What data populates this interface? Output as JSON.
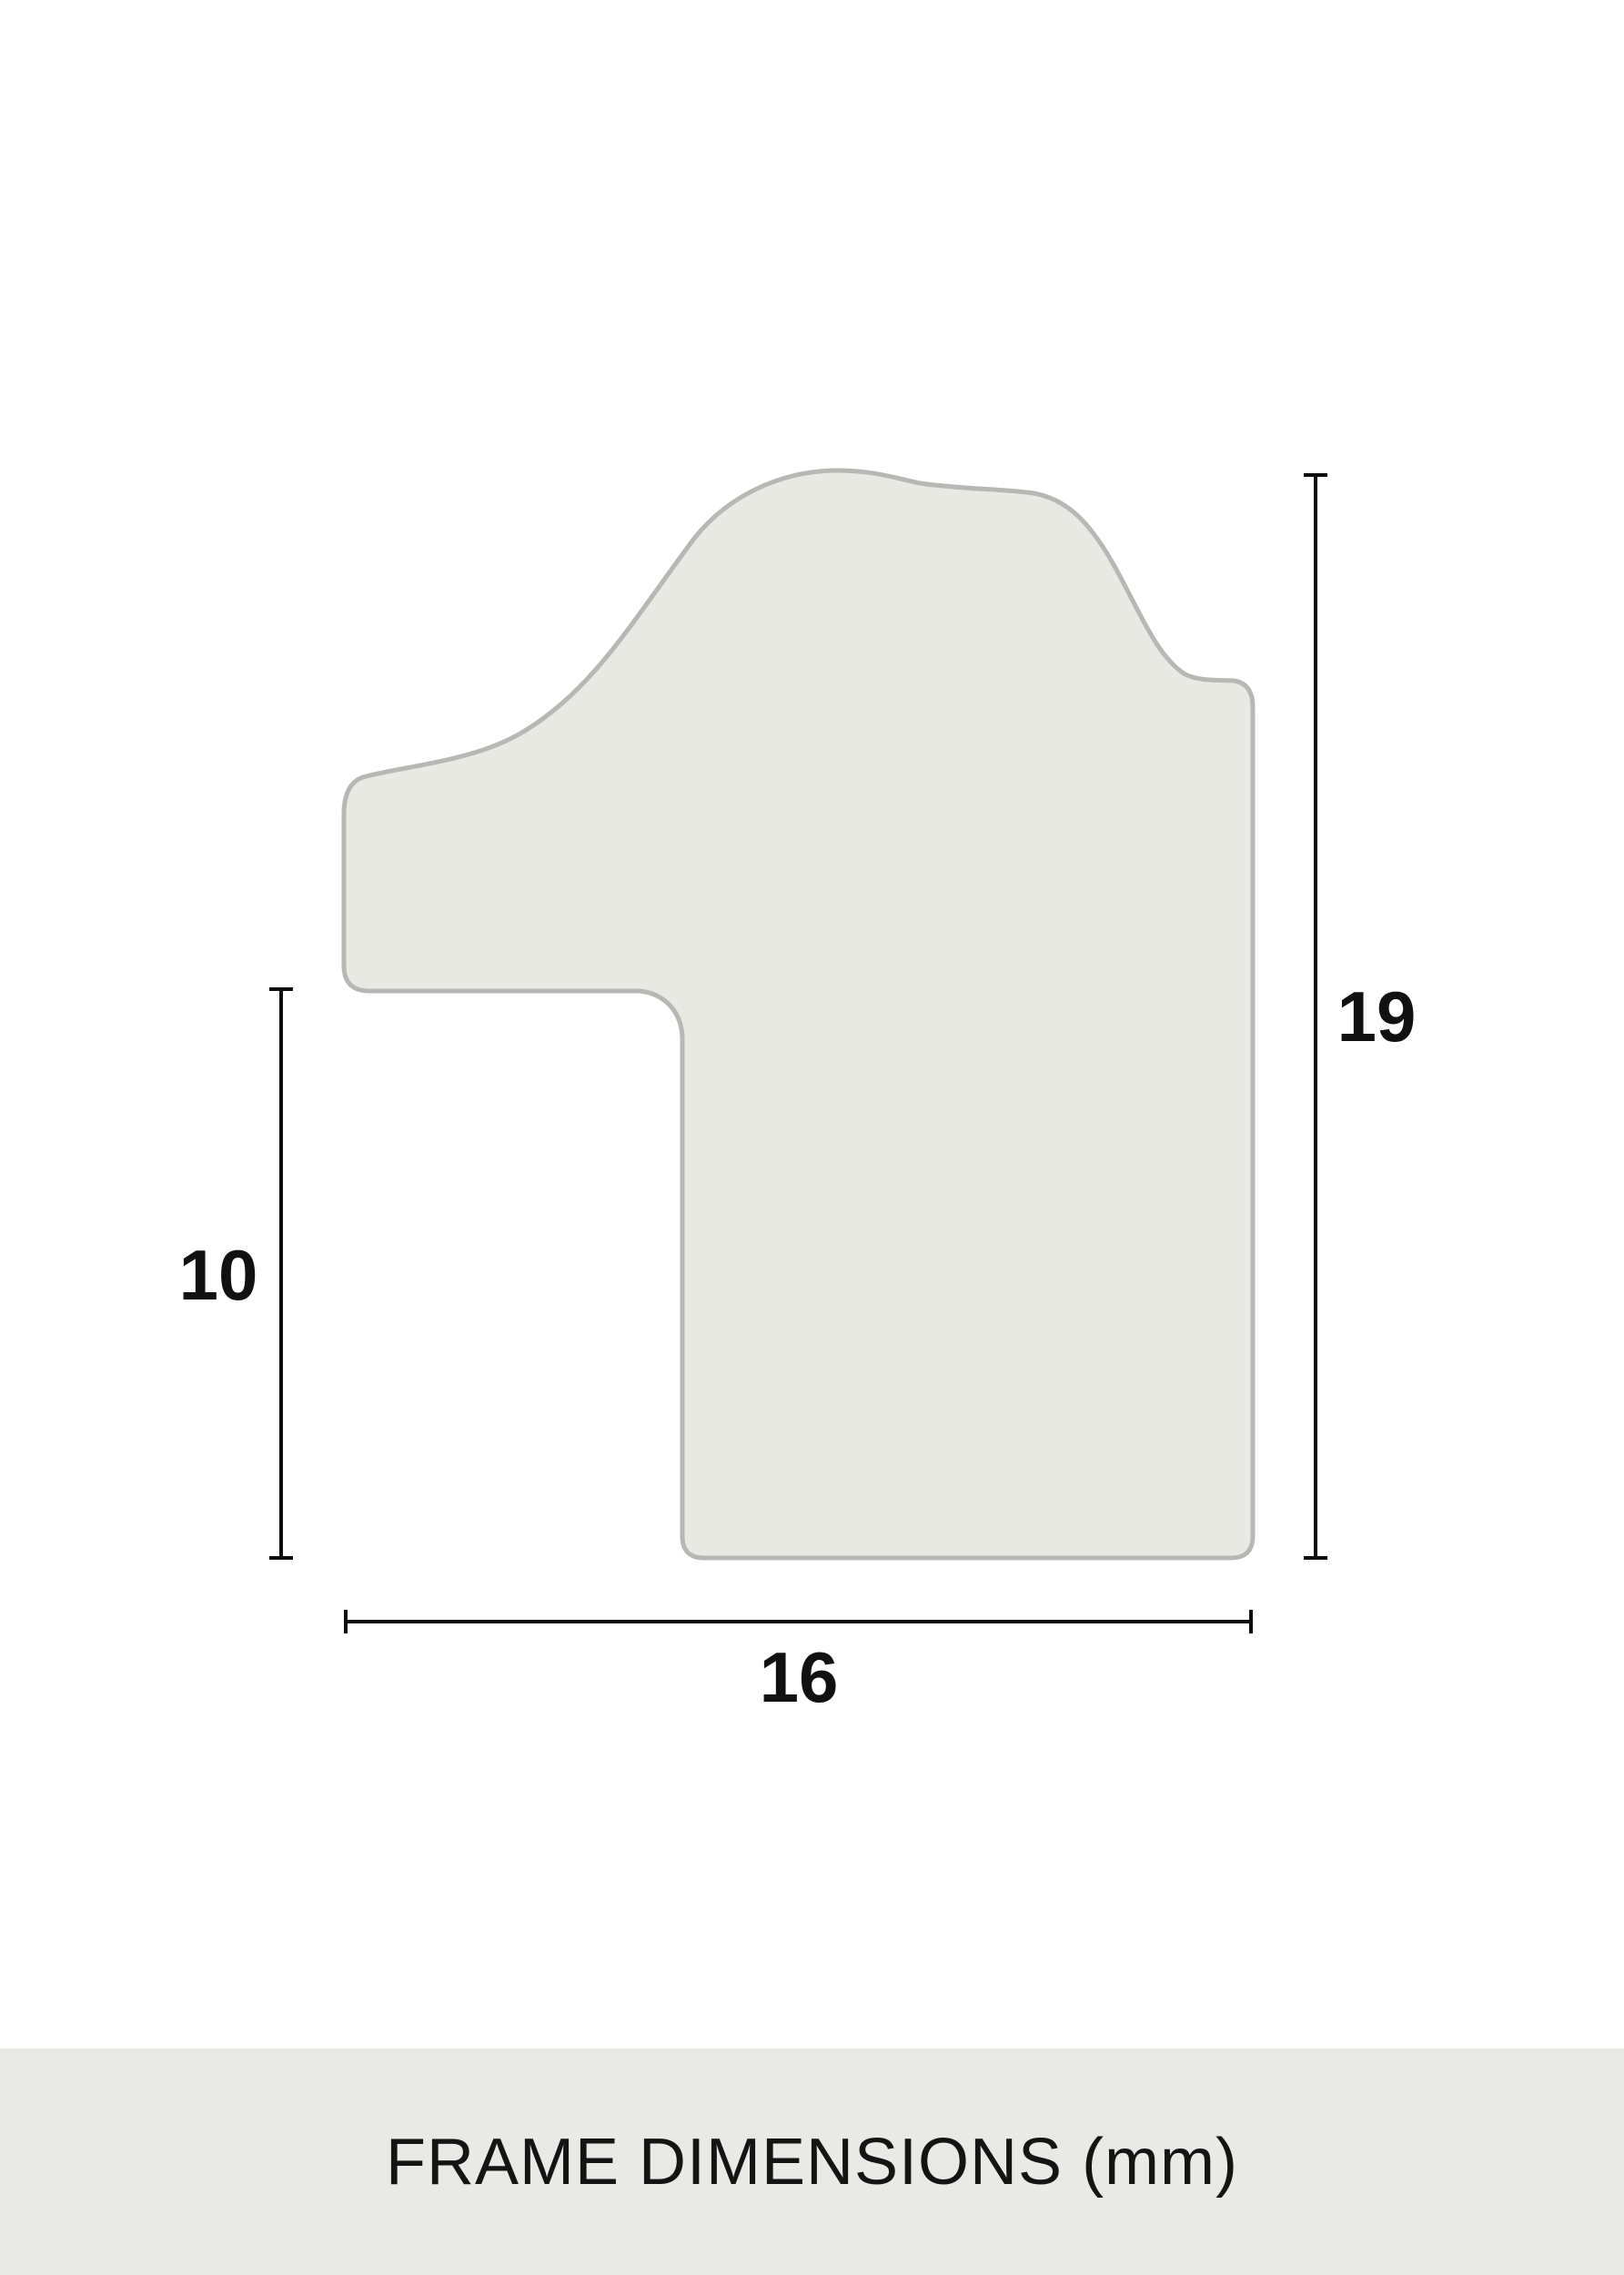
{
  "diagram": {
    "title": "frame moulding cross-section profile",
    "units": "mm",
    "measurements_mm": {
      "left_height": 10,
      "right_height": 19,
      "bottom_width": 16
    },
    "labels": {
      "left": "10",
      "right": "19",
      "bottom": "16"
    }
  },
  "footer": {
    "caption": "FRAME DIMENSIONS (mm)"
  },
  "colors": {
    "background": "#ffffff",
    "shape_fill": "#e9e9e4",
    "shape_stroke": "#b7b7b3",
    "dimension_line": "#0d0d0d",
    "label_text": "#111111",
    "footer_bg": "#e9e9e5",
    "footer_text": "#141414"
  }
}
